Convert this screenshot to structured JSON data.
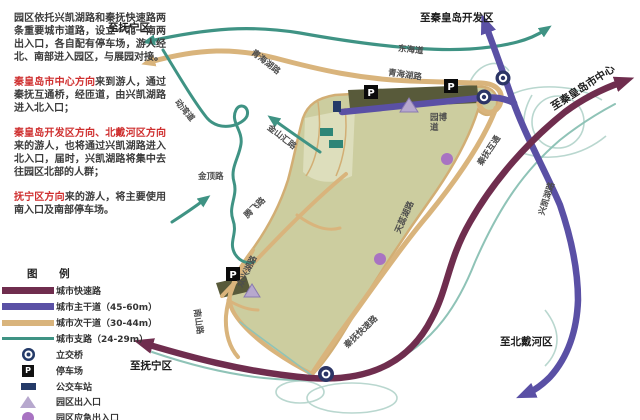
{
  "intro": {
    "paragraphs": [
      {
        "lead": "",
        "rest": "园区依托兴凯湖路和秦抚快速路两条重要城市道路，设立一北一南两出入口，各自配有停车场，游人经北、南部进入园区，与展园对接。"
      },
      {
        "lead": "秦皇岛市中心方向",
        "rest": "来到游人，通过秦抚互通桥，经匝道，由兴凯湖路进入北入口；"
      },
      {
        "lead": "秦皇岛开发区方向、北戴河区方向",
        "rest": "来的游人，也将通过兴凯湖路进入北入口，届时，兴凯湖路将集中去往园区北部的人群；"
      },
      {
        "lead": "抚宁区方向",
        "rest": "来的游人，将主要使用南入口及南部停车场。"
      }
    ]
  },
  "legend": {
    "title": "图 例",
    "items": [
      {
        "label": "城市快速路"
      },
      {
        "label": "城市主干道（45-60m）"
      },
      {
        "label": "城市次干道（30-44m）"
      },
      {
        "label": "城市支路（24-29m）"
      },
      {
        "label": "立交桥"
      },
      {
        "label": "停车场"
      },
      {
        "label": "公交车站"
      },
      {
        "label": "园区出入口"
      },
      {
        "label": "园区应急出入口"
      }
    ]
  },
  "map": {
    "destinations": [
      {
        "text": "至抚宁区"
      },
      {
        "text": "至秦皇岛开发区"
      },
      {
        "text": "至秦皇岛市中心"
      },
      {
        "text": "至北戴河区"
      },
      {
        "text": "至抚宁区"
      }
    ],
    "road_labels": [
      {
        "text": "东海道"
      },
      {
        "text": "青海湖路"
      },
      {
        "text": "青海湖路"
      },
      {
        "text": "动湾道"
      },
      {
        "text": "金山汇路"
      },
      {
        "text": "金顶路"
      },
      {
        "text": "腾飞路"
      },
      {
        "text": "众兴湖路"
      },
      {
        "text": "南山路"
      },
      {
        "text": "天蕊湖路"
      },
      {
        "text": "园博\n道"
      },
      {
        "text": "秦抚互通"
      },
      {
        "text": "兴凯湖路"
      },
      {
        "text": "秦抚快速路"
      }
    ],
    "parking_glyph": "P"
  },
  "colors": {
    "expressway": "#6f2d4e",
    "main_road": "#5a50a5",
    "secondary_road": "#d9b47c",
    "branch_road": "#3f9384",
    "ramp": "#b9d7cf",
    "park_fill": "#cccd9f",
    "parking_lot": "#585a3a",
    "interchange_icon": "#243a68",
    "emergency_exit": "#a873c2",
    "entrance_triangle": "#b7a8ce",
    "highlight_text": "#cf2e2e"
  }
}
